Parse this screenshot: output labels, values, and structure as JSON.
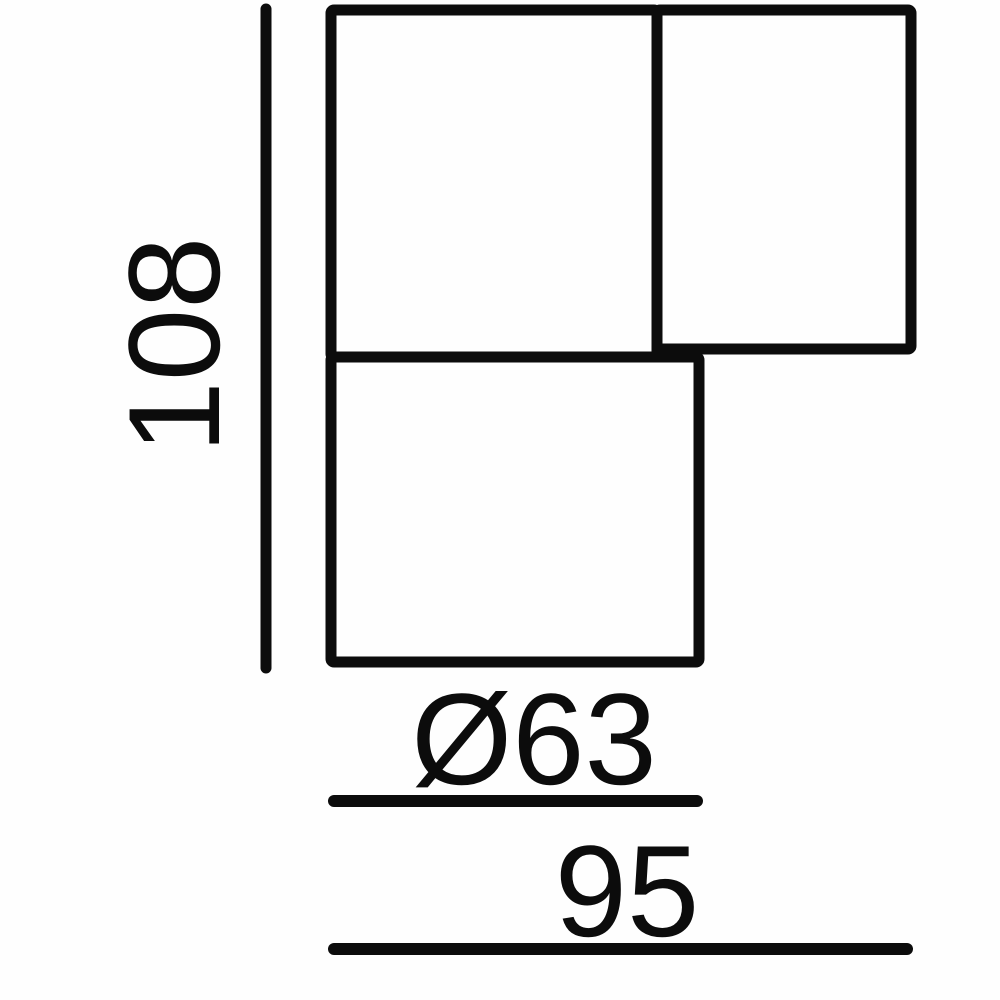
{
  "page": {
    "background": "#fefefe",
    "line_color": "#0c0c0c"
  },
  "dimensions": {
    "height_label": "108",
    "diameter_label": "Ø63",
    "width_label": "95"
  }
}
